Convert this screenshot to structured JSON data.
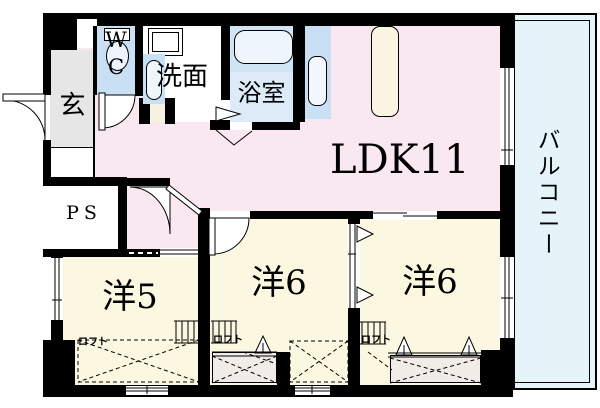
{
  "plan": {
    "type": "japanese-apartment-floor-plan",
    "rooms": {
      "genkan": {
        "label": "玄"
      },
      "wc": {
        "line1": "W",
        "line2": "C"
      },
      "washroom": {
        "label": "洗面"
      },
      "bathroom": {
        "label": "浴室"
      },
      "ldk": {
        "label": "LDK11"
      },
      "balcony": {
        "label": "バルコニー"
      },
      "pipe_space": {
        "label": "PS"
      },
      "western_room_5": {
        "label": "洋5"
      },
      "western_room_6_center": {
        "label": "洋6"
      },
      "western_room_6_right": {
        "label": "洋6"
      },
      "loft_west5": {
        "label": "ロフト"
      },
      "loft_center": {
        "label": "ロフト"
      },
      "loft_right": {
        "label": "ロフト"
      }
    },
    "colors": {
      "wall": "#000000",
      "ldk_floor": "#fae8f0",
      "bedroom_floor": "#fbf7e0",
      "balcony_floor": "#e4f4f9",
      "wet_area_blue": "#c9dff3",
      "bath_blue": "#cfe4f4",
      "bath_blue_light": "#dcebf7",
      "genkan_gray": "#e6e6e6",
      "closet_gray": "#f1ece8",
      "counter_cream": "#faf5e1"
    }
  }
}
